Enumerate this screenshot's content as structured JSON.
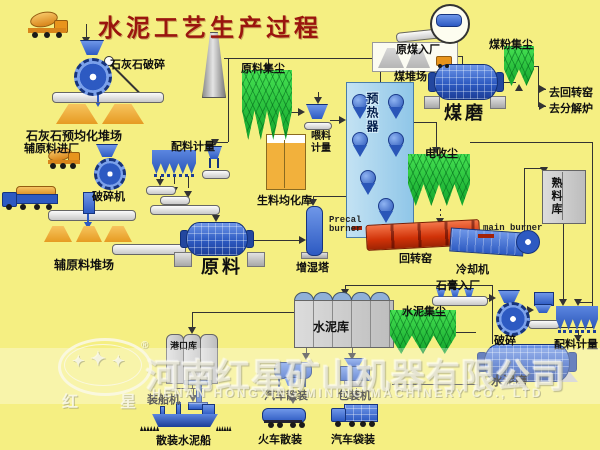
{
  "title": "水泥工艺生产过程",
  "colors": {
    "background": "#f5ef82",
    "title_red": "#9a150e",
    "machine_blue": "#2d5ac2",
    "collector_green": "#12a52c",
    "kiln_red": "#d03208",
    "stock_orange": "#e69b22",
    "silo_gray": "#c9c9c9"
  },
  "labels": {
    "limestone_crushing": "石灰石破碎",
    "limestone_yard": "石灰石预均化堆场",
    "aux_entry": "辅原料进厂",
    "crusher_machine": "破碎机",
    "aux_yard": "辅原料堆场",
    "batching_left": "配料计量",
    "raw_mill": "原料",
    "humidifier_tower": "增湿塔",
    "raw_meal_silo": "生料均化库",
    "feeding_metering": "喂料计量",
    "preheater": "预热器",
    "raw_dust": "原料集尘",
    "raw_coal_entry": "原煤入厂",
    "coal_yard": "煤堆场",
    "coal_dust": "煤粉集尘",
    "coal_mill": "煤磨",
    "to_rotary_kiln": "去回转窑",
    "to_calciner": "去分解炉",
    "esp": "电收尘",
    "clinker_silo": "熟料库",
    "precal_burner_1": "Precal",
    "precal_burner_2": "burner",
    "main_burner": "main burner",
    "rotary_kiln": "回转窑",
    "cooler": "冷却机",
    "gypsum_entry": "石膏入厂",
    "cement_dust": "水泥集尘",
    "gypsum_crusher": "破碎",
    "batching_right": "配料计量",
    "cement_mill": "水泥磨",
    "cement_silo": "水泥库",
    "port_silo": "港口库",
    "ship_loader": "装船机",
    "bulk_cement_ship": "散装水泥船",
    "truck_bulk": "汽车散装",
    "packing_machine": "包装机",
    "train_bulk": "火车散装",
    "truck_bag": "汽车袋装"
  },
  "watermark": {
    "company_cn": "河南红星矿山机器有限公司",
    "company_en": "HENAN HONGXING MINING MACHINERY CO., LTD",
    "logo_left": "红",
    "logo_right": "星",
    "registered": "®",
    "star": "✦"
  }
}
